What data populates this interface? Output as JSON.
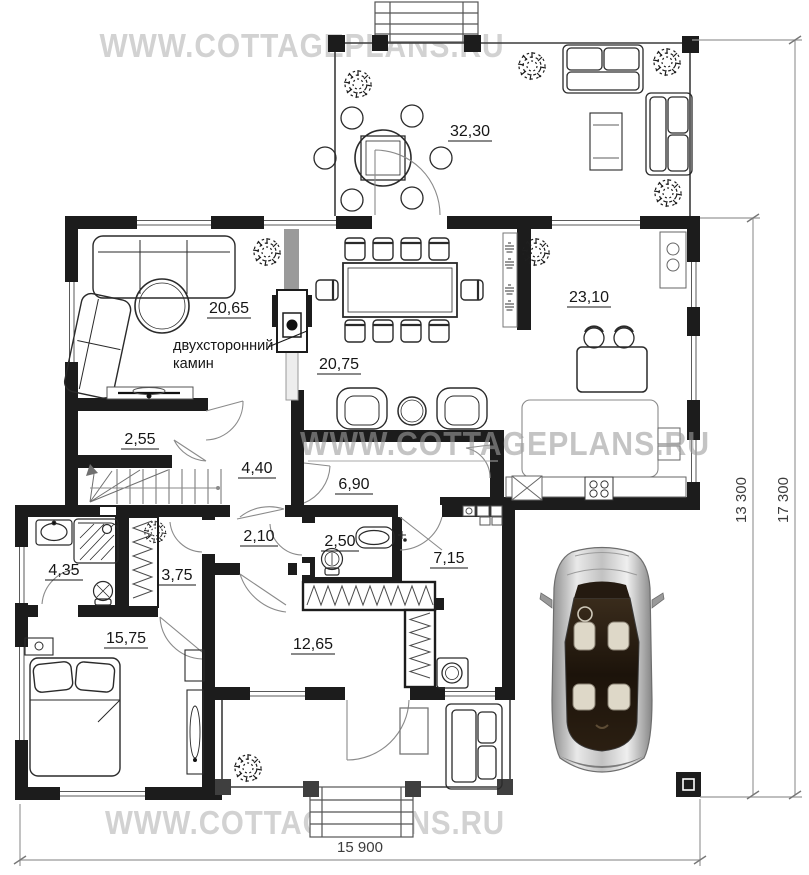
{
  "watermarks": {
    "top": "WWW.COTTAGEPLANS.RU",
    "middle": "WWW.COTTAGEPLANS.RU",
    "bottom": "WWW.COTTAGEPLANS.RU"
  },
  "areas": {
    "terrace": "32,30",
    "living": "20,65",
    "dining": "20,75",
    "kitchen": "23,10",
    "closet": "2,55",
    "hall": "4,40",
    "hallway": "6,90",
    "corridor": "2,10",
    "wc": "2,50",
    "utility": "7,15",
    "bathroom": "4,35",
    "wardrobe": "3,75",
    "bedroom": "15,75",
    "dressing": "12,65"
  },
  "labels": {
    "fireplace_line1": "двухсторонний",
    "fireplace_line2": "камин"
  },
  "dimensions": {
    "bottom_width": "15 900",
    "inner_height": "13 300",
    "outer_height": "17 300"
  },
  "colors": {
    "wall": "#1c1c1c",
    "watermark_light": "#d2d2d2",
    "watermark_overlay": "#9e9e9e",
    "dimension_line": "#999999"
  }
}
